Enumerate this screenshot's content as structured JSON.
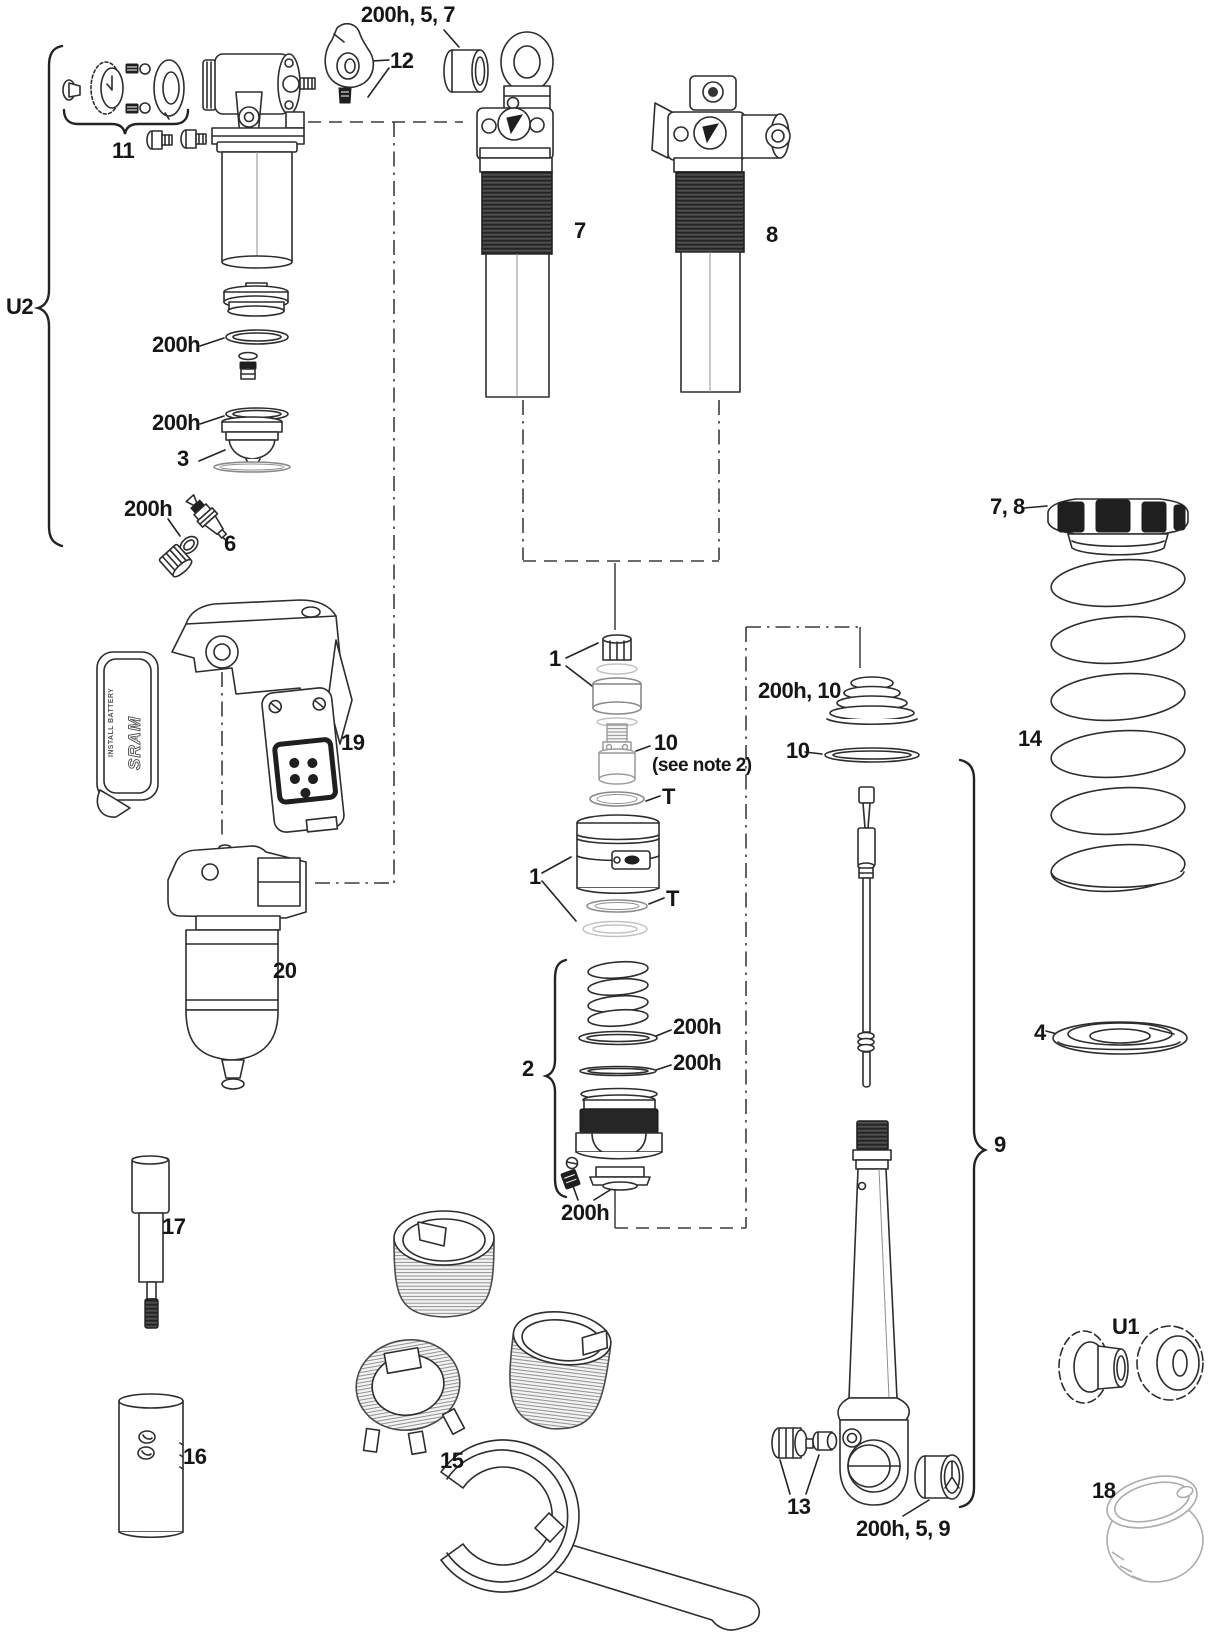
{
  "figure": {
    "background_color": "#ffffff",
    "line_color": "#2d2d2d",
    "brand_text": "SRAM",
    "battery_cover_text": "INSTALL BATTERY"
  },
  "callouts": {
    "bushing_top": "200h, 5, 7",
    "lever": "12",
    "knob_kit": "11",
    "u2_group": "U2",
    "oring_a": "200h",
    "oring_b": "200h",
    "seal_head": "3",
    "valve_oring": "200h",
    "valve_core": "6",
    "shock_left": "7",
    "shock_right": "8",
    "stack_top": "1",
    "floating_piston": "10",
    "floating_piston_note": "(see note 2)",
    "t_upper": "T",
    "air_can": "1",
    "t_lower": "T",
    "wiper_group": "200h, 10",
    "wiper_ring": "10",
    "piston_group": "2",
    "glide_ring_a": "200h",
    "glide_ring_b": "200h",
    "bottom_cap": "200h",
    "shaft_group": "9",
    "shaft_nuts": "13",
    "eyelet_bushing": "200h, 5, 9",
    "preload_collar": "7, 8",
    "coil_spring": "14",
    "spring_seat": "4",
    "u1_group": "U1",
    "remote_unit": "19",
    "motor_unit": "20",
    "shaft_clamp_tool": "17",
    "sleeve_tool": "16",
    "body_sleeves": "15",
    "storage_cup": "18"
  }
}
